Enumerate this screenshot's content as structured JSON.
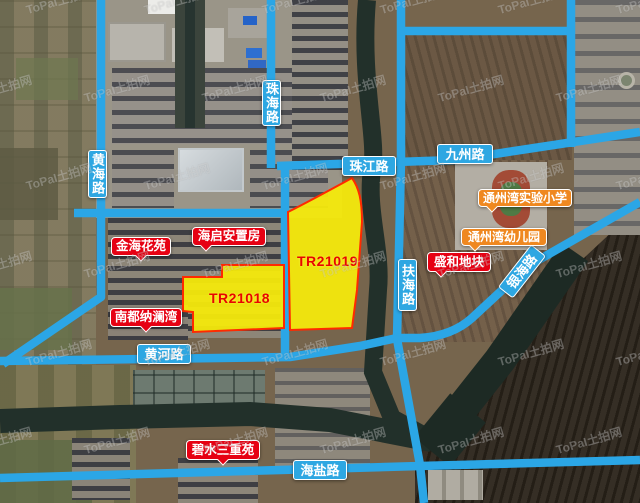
{
  "map": {
    "source_brand": "ToPaI",
    "source_brand_cn": "土拍网",
    "description_visible": "satellite land-parcel map with highlighted roads and two auction parcels"
  },
  "watermark": {
    "brand": "ToPaI",
    "cn": "土拍网"
  },
  "roads": {
    "zhuhai": "珠海路",
    "huanghai": "黄海路",
    "zhujiang": "珠江路",
    "jiuzhou": "九州路",
    "fuhai": "扶海路",
    "yinhai": "银海路",
    "huanghe": "黄河路",
    "haiyan": "海盐路"
  },
  "parcels": {
    "p18": {
      "id": "TR21018"
    },
    "p19": {
      "id": "TR21019"
    }
  },
  "places": {
    "jinhai": "金海花苑",
    "haiqi": "海启安置房",
    "nandu": "南都纳澜湾",
    "shenghe": "盛和地块",
    "bishui": "碧水三重苑",
    "school": "通州湾实验小学",
    "kinder": "通州湾幼儿园"
  },
  "colors": {
    "road": "#2ba6e6",
    "road_label_bg": "#2ea7e2",
    "parcel_fill": "#f4e90c",
    "parcel_border": "#ff2a00",
    "parcel_text": "#e80500",
    "estate_label_bg": "#e60113",
    "school_label_bg": "#ef8820",
    "water": "#22302a"
  }
}
